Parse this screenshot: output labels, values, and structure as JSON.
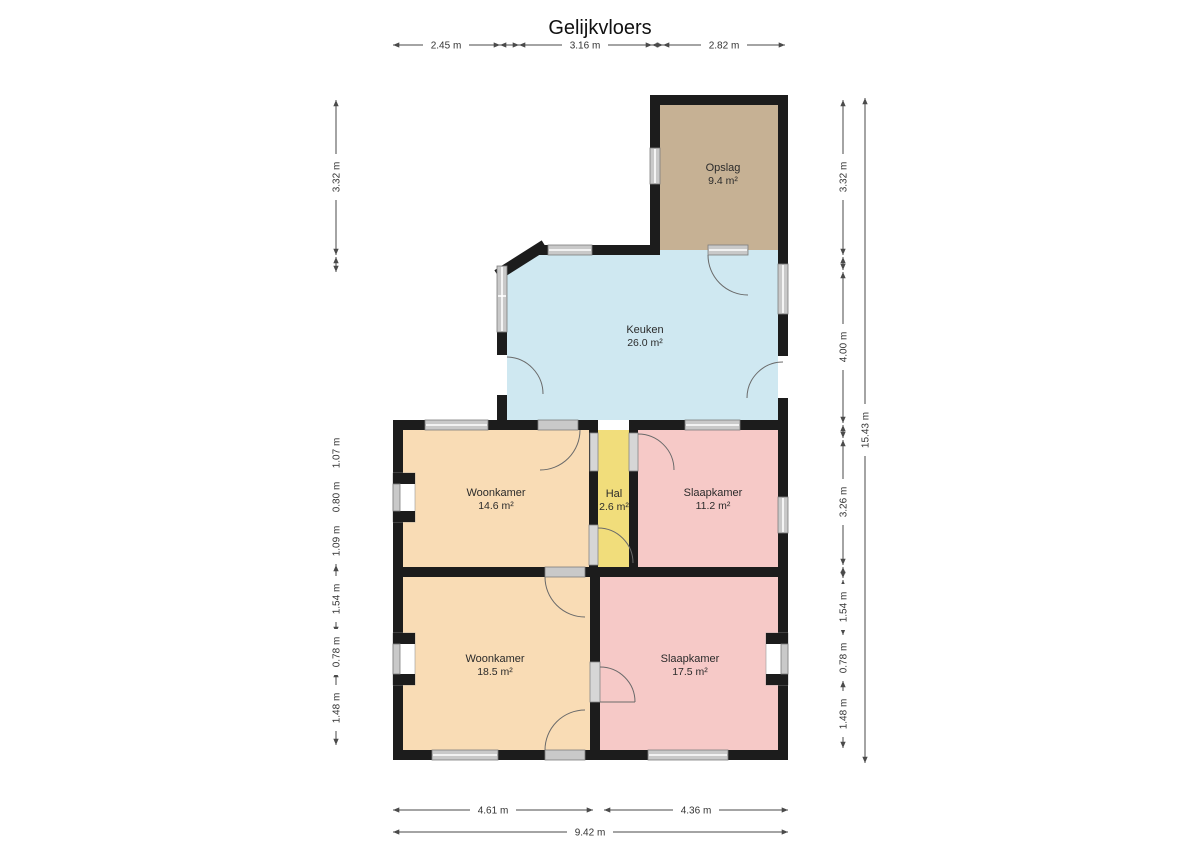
{
  "title": "Gelijkvloers",
  "rooms": {
    "opslag": {
      "name": "Opslag",
      "area": "9.4 m²"
    },
    "keuken": {
      "name": "Keuken",
      "area": "26.0 m²"
    },
    "woonkamer1": {
      "name": "Woonkamer",
      "area": "14.6 m²"
    },
    "hal": {
      "name": "Hal",
      "area": "2.6 m²"
    },
    "slaapkamer1": {
      "name": "Slaapkamer",
      "area": "11.2 m²"
    },
    "woonkamer2": {
      "name": "Woonkamer",
      "area": "18.5 m²"
    },
    "slaapkamer2": {
      "name": "Slaapkamer",
      "area": "17.5 m²"
    }
  },
  "dims": {
    "top": [
      "2.45 m",
      "3.16 m",
      "2.82 m"
    ],
    "left": [
      "3.32 m",
      "1.07 m",
      "0.80 m",
      "1.09 m",
      "1.54 m",
      "0.78 m",
      "1.48 m"
    ],
    "right": [
      "3.32 m",
      "4.00 m",
      "3.26 m",
      "1.54 m",
      "0.78 m",
      "1.48 m"
    ],
    "right_total": "15.43 m",
    "bottom": [
      "4.61 m",
      "4.36 m"
    ],
    "bottom_total": "9.42 m"
  },
  "colors": {
    "wall": "#1c1c1c",
    "opslag": "#c6b194",
    "keuken": "#cfe8f1",
    "woonkamer": "#f9dcb5",
    "hal": "#f1dd7b",
    "slaapkamer": "#f6c9c7",
    "window": "#c9c9c9"
  }
}
